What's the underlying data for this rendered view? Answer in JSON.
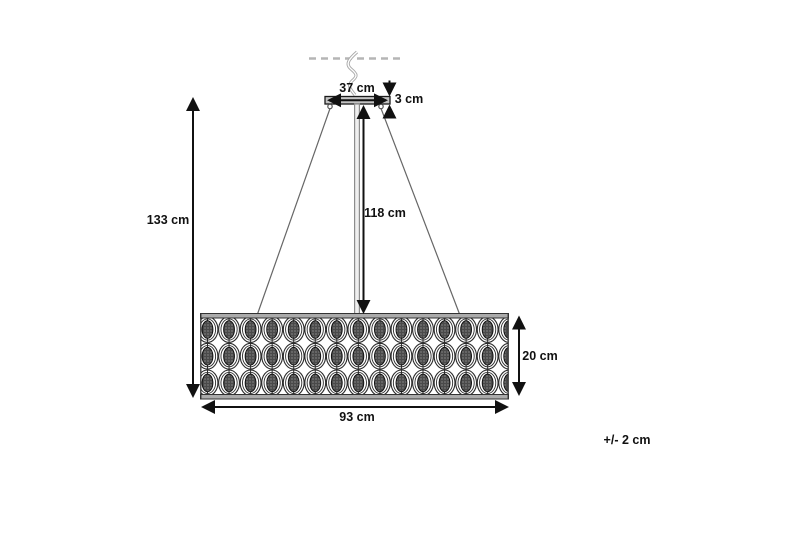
{
  "diagram": {
    "type": "product-dimension-drawing",
    "subject": "pendant-lamp",
    "dimensions": {
      "canopy_width": "37 cm",
      "canopy_height": "3 cm",
      "rod_length": "118 cm",
      "total_height": "133 cm",
      "shade_height": "20 cm",
      "shade_width": "93 cm"
    },
    "tolerance_note": "+/- 2 cm",
    "pattern": {
      "rows": 3,
      "columns": 15,
      "unit": "crystal-oval-in-double-ring"
    },
    "colors": {
      "line_black": "#111111",
      "frame_gray": "#ababab",
      "cable_gray": "#8c8c8c",
      "ceiling_dash_gray": "#b5b5b5",
      "crystal_dark": "#4a4a4a",
      "background": "#ffffff"
    }
  }
}
